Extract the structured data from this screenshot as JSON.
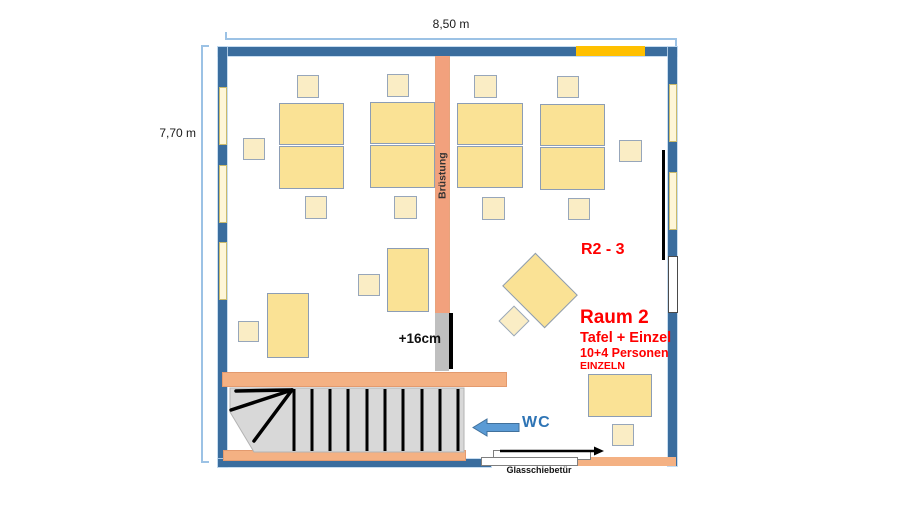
{
  "labels": {
    "top_dimension": "8,50 m",
    "left_dimension": "7,70 m",
    "bruestung": "Brüstung",
    "step_height": "+16cm",
    "room_code": "R2 - 3",
    "room_name": "Raum 2",
    "room_line1": "Tafel + Einzel",
    "room_line2": "10+4 Personen",
    "room_line3": "EINZELN",
    "wc": "WC",
    "glass_door": "Glasschiebetür"
  },
  "colors": {
    "wall": "#3a6d9e",
    "accent_orange": "#ffc000",
    "salmon": "#f4b183",
    "column": "#f2a17d",
    "table_fill": "#fae295",
    "chair_fill": "#faedc5",
    "window_fill": "#fef6d8",
    "dimension_line": "#9cc2e5",
    "red_text": "#ff0000",
    "wc_blue": "#2e74b5",
    "arrow_blue": "#5b9bd5",
    "stair_gray": "#d8d8d8",
    "step_gray": "#bfbfbf"
  },
  "furniture": {
    "tables": [
      [
        279,
        103,
        65,
        42
      ],
      [
        279,
        146,
        65,
        43
      ],
      [
        370,
        102,
        65,
        42
      ],
      [
        370,
        145,
        65,
        43
      ],
      [
        457,
        103,
        66,
        42
      ],
      [
        457,
        146,
        66,
        42
      ],
      [
        540,
        104,
        65,
        42
      ],
      [
        540,
        147,
        65,
        43
      ],
      [
        267,
        293,
        42,
        65
      ],
      [
        387,
        248,
        42,
        64
      ],
      [
        588,
        374,
        64,
        43
      ]
    ],
    "chairs": [
      [
        297,
        75,
        22,
        23
      ],
      [
        387,
        74,
        22,
        23
      ],
      [
        474,
        75,
        23,
        23
      ],
      [
        557,
        76,
        22,
        22
      ],
      [
        305,
        196,
        22,
        23
      ],
      [
        394,
        196,
        23,
        23
      ],
      [
        482,
        197,
        23,
        23
      ],
      [
        568,
        198,
        22,
        22
      ],
      [
        243,
        138,
        22,
        22
      ],
      [
        619,
        140,
        23,
        22
      ],
      [
        238,
        321,
        21,
        21
      ],
      [
        358,
        274,
        22,
        22
      ],
      [
        612,
        424,
        22,
        22
      ]
    ],
    "diamond_table": {
      "cx": 540,
      "cy": 290,
      "w": 60,
      "h": 47,
      "angle": 45
    },
    "diamond_chair": {
      "cx": 514,
      "cy": 321,
      "w": 22,
      "h": 22,
      "angle": 45
    },
    "windows_left": [
      [
        219,
        87,
        8,
        58
      ],
      [
        219,
        165,
        8,
        58
      ],
      [
        219,
        242,
        8,
        58
      ]
    ],
    "windows_right": [
      [
        669,
        84,
        8,
        58
      ],
      [
        669,
        172,
        8,
        58
      ]
    ]
  },
  "stairs": {
    "treads": [
      294,
      312,
      330,
      348,
      367,
      385,
      403,
      422,
      440,
      458
    ],
    "tread_top": 389,
    "tread_bottom": 451,
    "fan": [
      [
        292,
        390,
        236,
        391
      ],
      [
        292,
        390,
        231,
        410
      ],
      [
        292,
        390,
        254,
        441
      ]
    ]
  }
}
